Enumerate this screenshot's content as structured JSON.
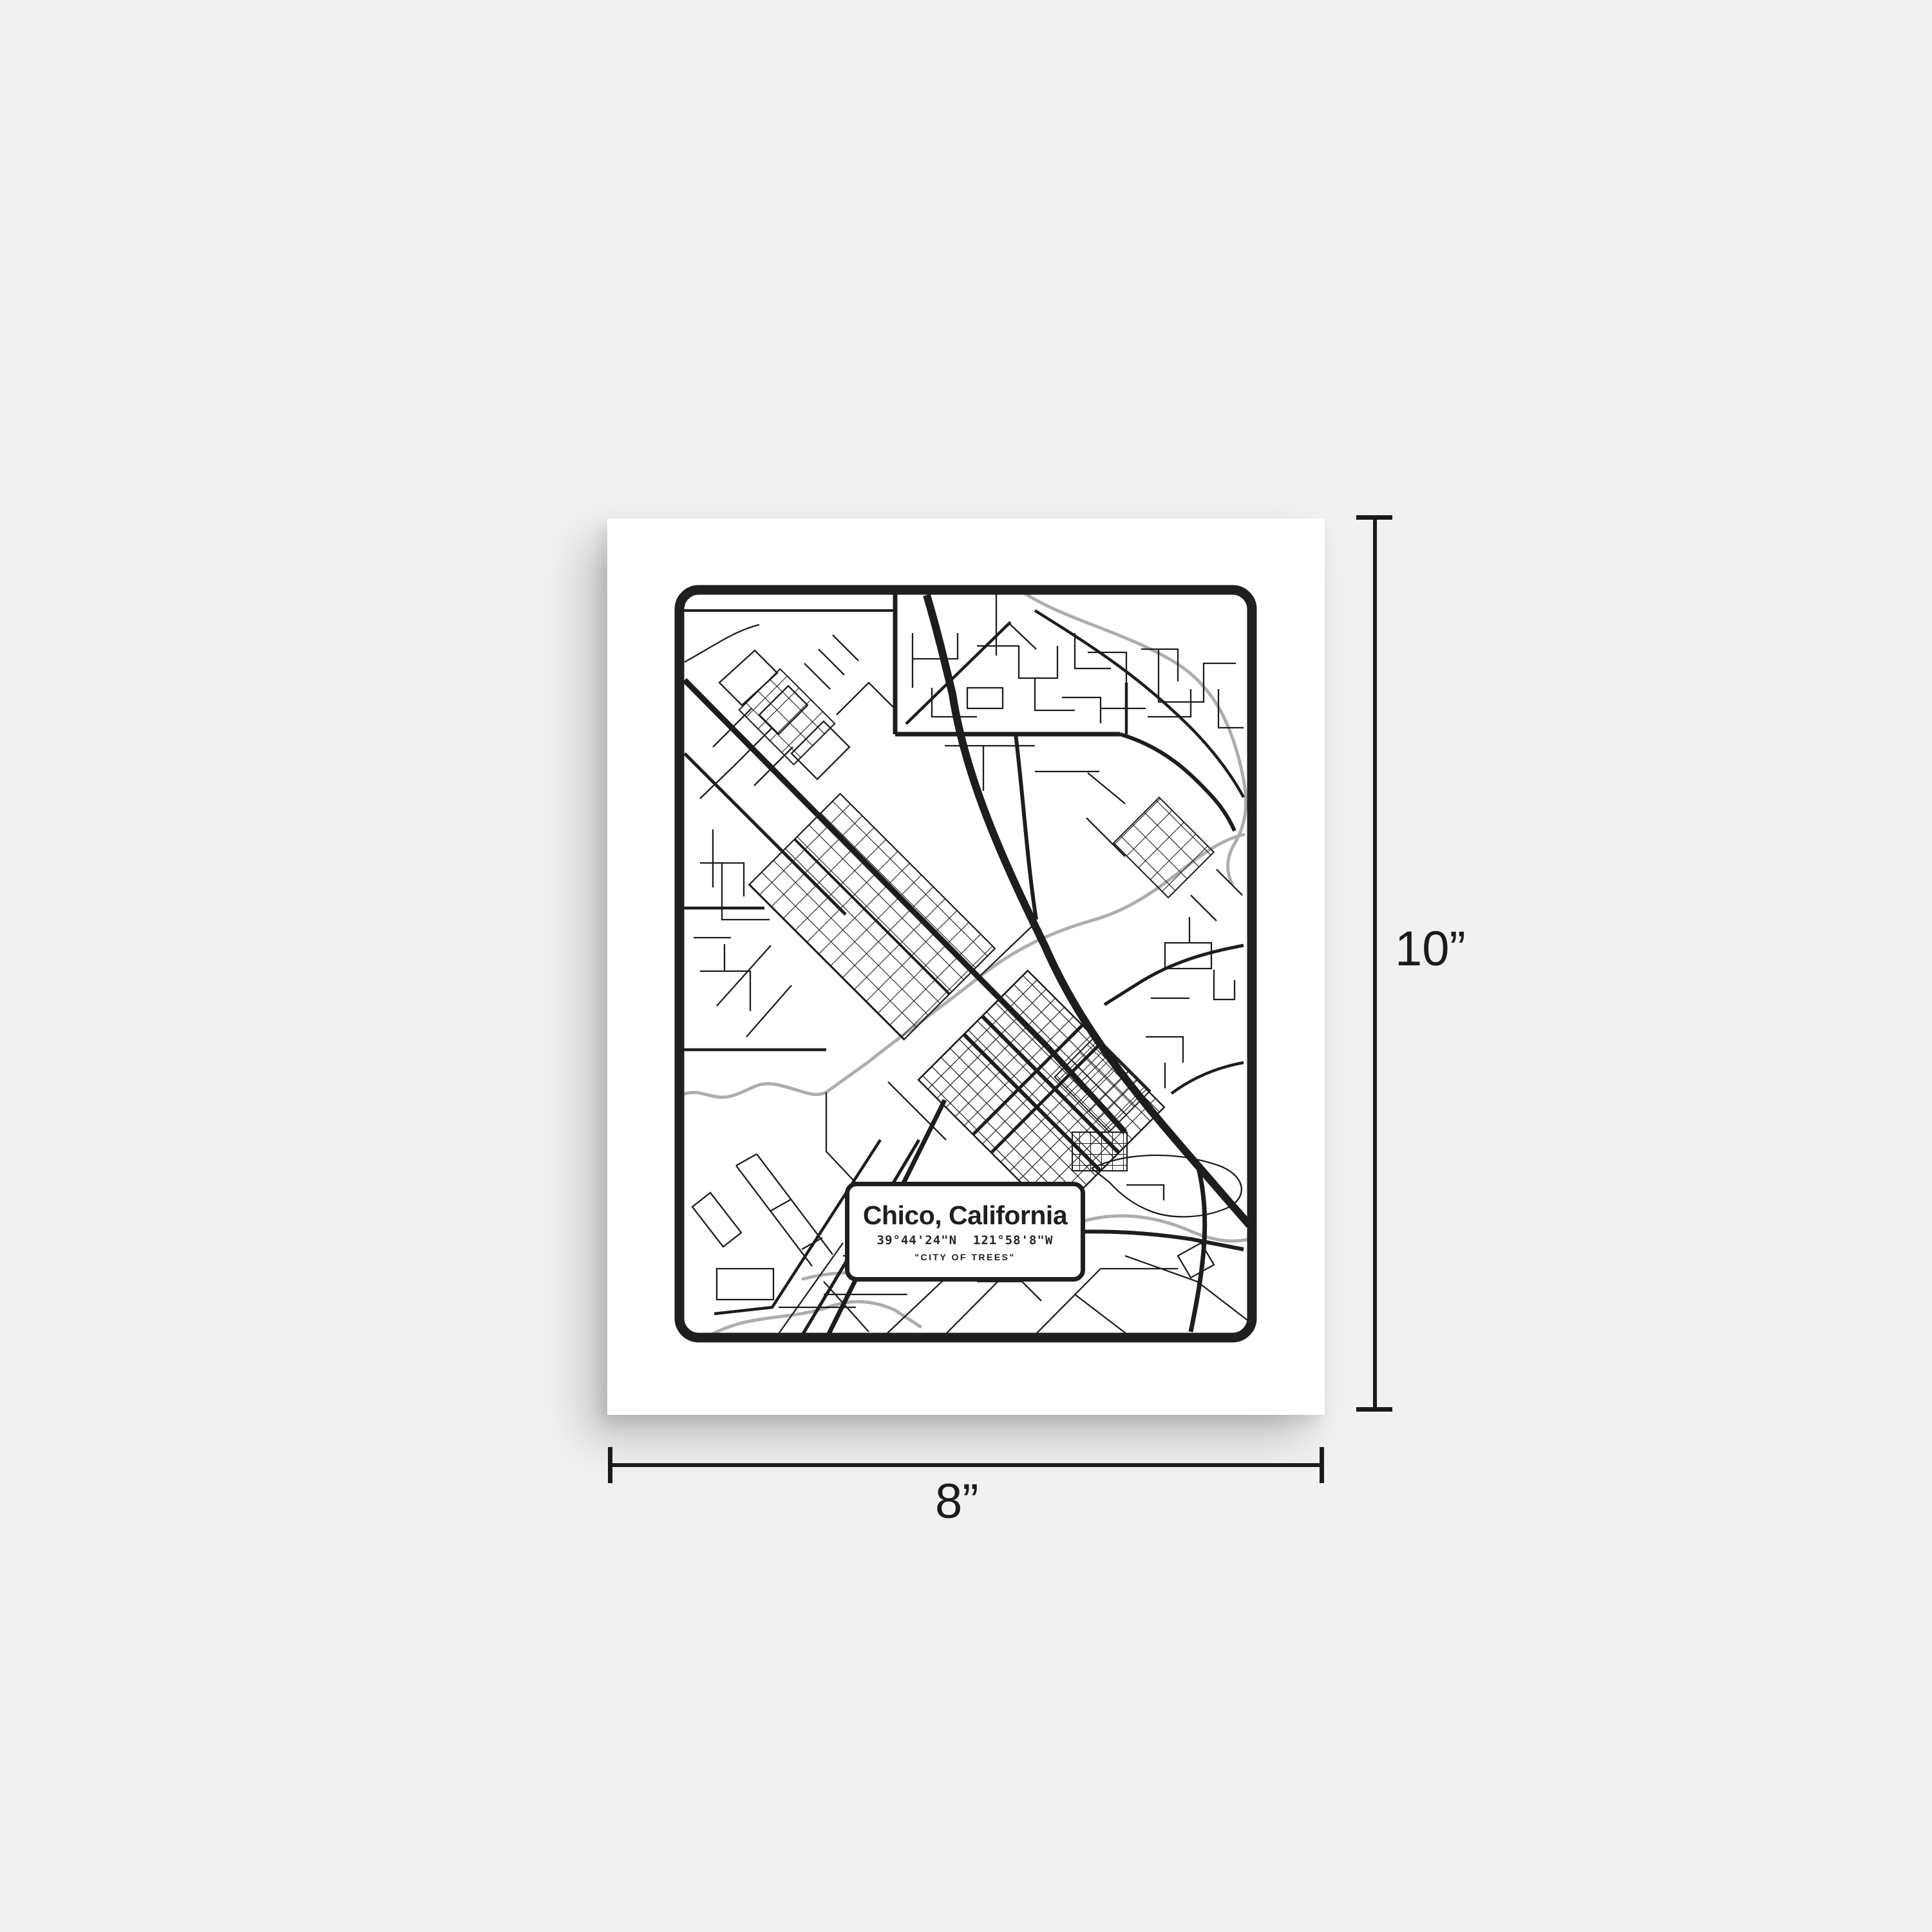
{
  "scene": {
    "background_color": "#f1f1f2"
  },
  "poster": {
    "paper_color": "#ffffff",
    "map": {
      "ink_color": "#1d1d1b",
      "water_color": "#adadad",
      "label": {
        "title": "Chico, California",
        "coordinates": "39°44'24\"N  121°58'8\"W",
        "tagline": "\"CITY OF TREES\""
      }
    }
  },
  "dimensions": {
    "height_label": "10”",
    "width_label": "8”"
  }
}
